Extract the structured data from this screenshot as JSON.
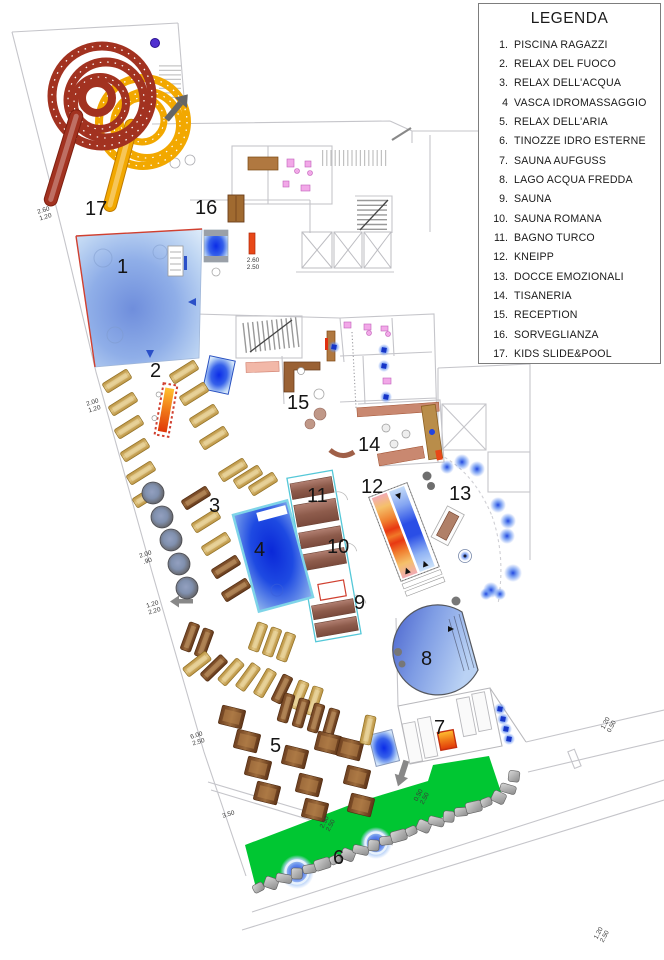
{
  "legend": {
    "title": "LEGENDA",
    "items": [
      {
        "num": "1.",
        "label": "PISCINA RAGAZZI"
      },
      {
        "num": "2.",
        "label": "RELAX DEL FUOCO"
      },
      {
        "num": "3.",
        "label": "RELAX DELL'ACQUA"
      },
      {
        "num": "4",
        "label": "VASCA IDROMASSAGGIO"
      },
      {
        "num": "5.",
        "label": "RELAX DELL'ARIA"
      },
      {
        "num": "6.",
        "label": "TINOZZE IDRO ESTERNE"
      },
      {
        "num": "7.",
        "label": "SAUNA AUFGUSS"
      },
      {
        "num": "8.",
        "label": "LAGO ACQUA FREDDA"
      },
      {
        "num": "9.",
        "label": "SAUNA"
      },
      {
        "num": "10.",
        "label": "SAUNA ROMANA"
      },
      {
        "num": "11.",
        "label": "BAGNO TURCO"
      },
      {
        "num": "12.",
        "label": "KNEIPP"
      },
      {
        "num": "13.",
        "label": "DOCCE EMOZIONALI"
      },
      {
        "num": "14.",
        "label": "TISANERIA"
      },
      {
        "num": "15.",
        "label": "RECEPTION"
      },
      {
        "num": "16.",
        "label": "SORVEGLIANZA"
      },
      {
        "num": "17.",
        "label": "KIDS SLIDE&POOL"
      }
    ]
  },
  "plan": {
    "zone_numbers": [
      "1",
      "2",
      "3",
      "4",
      "5",
      "6",
      "7",
      "8",
      "9",
      "10",
      "11",
      "12",
      "13",
      "14",
      "15",
      "16",
      "17"
    ],
    "dimension_labels": [
      {
        "lines": [
          "2.60",
          "1.20"
        ]
      },
      {
        "lines": [
          "2.60",
          "2.50"
        ]
      },
      {
        "lines": [
          "2.00",
          "1.20"
        ]
      },
      {
        "lines": [
          "2.00",
          ".90"
        ]
      },
      {
        "lines": [
          "1.20",
          "2.20"
        ]
      },
      {
        "lines": [
          "6.00",
          "2.50"
        ]
      },
      {
        "lines": [
          "3.50"
        ]
      },
      {
        "lines": [
          "2.50",
          "2.50"
        ]
      },
      {
        "lines": [
          "0.50",
          "2.50"
        ]
      },
      {
        "lines": [
          "1.20",
          "0.50"
        ]
      },
      {
        "lines": [
          "1.20",
          "2.50"
        ]
      }
    ]
  },
  "colors": {
    "slide_red": "#A23220",
    "slide_yellow": "#F2A800",
    "pool_blue": "#6F8EDC",
    "whirlpool_blue": "#1E4AE2",
    "lawn_green": "#00C632",
    "lounger_tan": "#CCA254",
    "lounger_dark": "#7B4A2D",
    "sauna_wood": "#8E5C4C",
    "stove_orange": "#F07818",
    "kneipp_warm": "#E83812",
    "kneipp_cool": "#2A4EE6",
    "fixture_pink": "#F2A8E8"
  }
}
